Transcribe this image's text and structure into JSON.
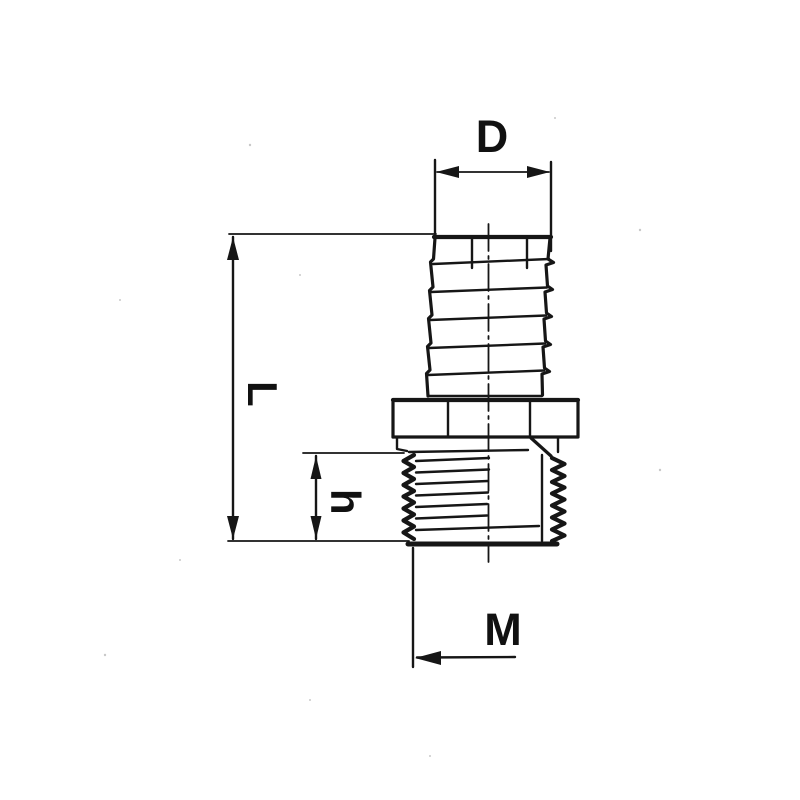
{
  "drawing": {
    "type": "technical-dimension-drawing",
    "subject": "hose barb to male thread adapter fitting",
    "background_color": "#ffffff",
    "line_color": "#161616",
    "labels": {
      "barb_diameter": "D",
      "overall_length": "L",
      "thread_length": "h",
      "thread_size": "M"
    }
  }
}
